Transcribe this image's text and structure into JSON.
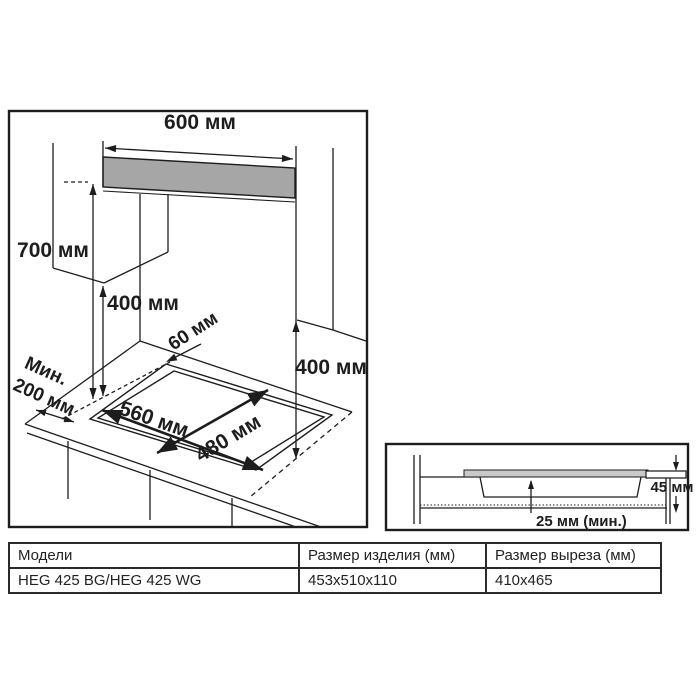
{
  "main_diagram": {
    "dims": {
      "hood_width": "600 мм",
      "hood_clearance": "700 мм",
      "cabinet_clearance": "400 мм",
      "right_clearance": "400 мм",
      "side_min_word": "Мин.",
      "side_min_value": "200 мм",
      "back_gap": "60 мм",
      "cutout_width": "560 мм",
      "cutout_depth": "480 мм"
    }
  },
  "detail_diagram": {
    "dims": {
      "edge_height": "45 мм",
      "bottom_clearance": "25 мм (мин.)"
    }
  },
  "table": {
    "headers": [
      "Модели",
      "Размер изделия (мм)",
      "Размер выреза (мм)"
    ],
    "rows": [
      [
        "HEG 425 BG/HEG 425 WG",
        "453x510x110",
        "410x465"
      ]
    ]
  },
  "colors": {
    "line": "#1d1d1d",
    "hood_fill": "#a6a6a6",
    "glass_fill": "#c9c9c9",
    "background": "#ffffff"
  }
}
